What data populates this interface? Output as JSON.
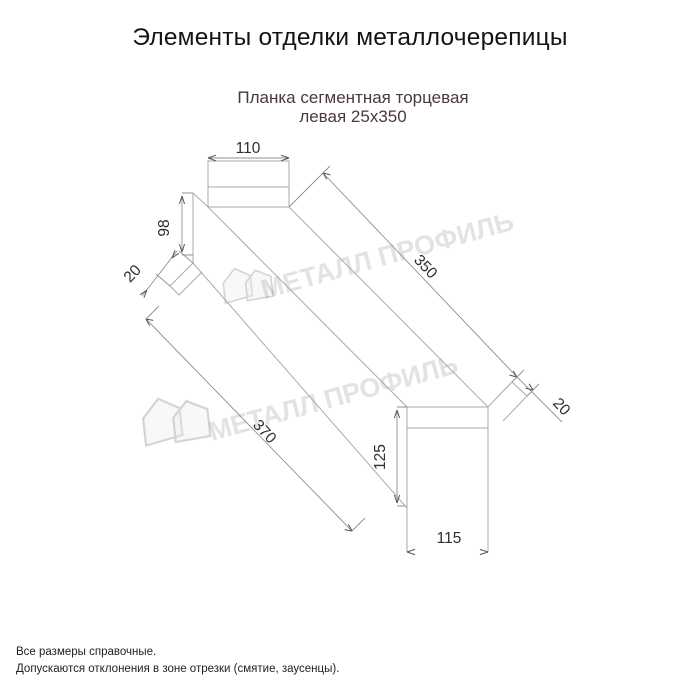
{
  "title": "Элементы отделки металлочерепицы",
  "subtitle": {
    "line1": "Планка сегментная торцевая",
    "line2": "левая 25х350"
  },
  "watermark": {
    "text": "МЕТАЛЛ ПРОФИЛЬ"
  },
  "dims": {
    "top_width": "110",
    "left_height": "98",
    "left_tab": "20",
    "length_top": "350",
    "length_bottom": "370",
    "right_tab": "20",
    "bottom_height": "125",
    "bottom_width": "115"
  },
  "notes": [
    "Все размеры справочные.",
    "Допускаются отклонения в зоне отрезки (смятие, заусенцы)."
  ],
  "colors": {
    "title_text": "#141414",
    "subtitle_text": "#4a3939",
    "drawing_lines": "#aaaaaa",
    "dimension_text": "#2e2e2e",
    "watermark": "#d4d4d4",
    "background": "#ffffff"
  }
}
